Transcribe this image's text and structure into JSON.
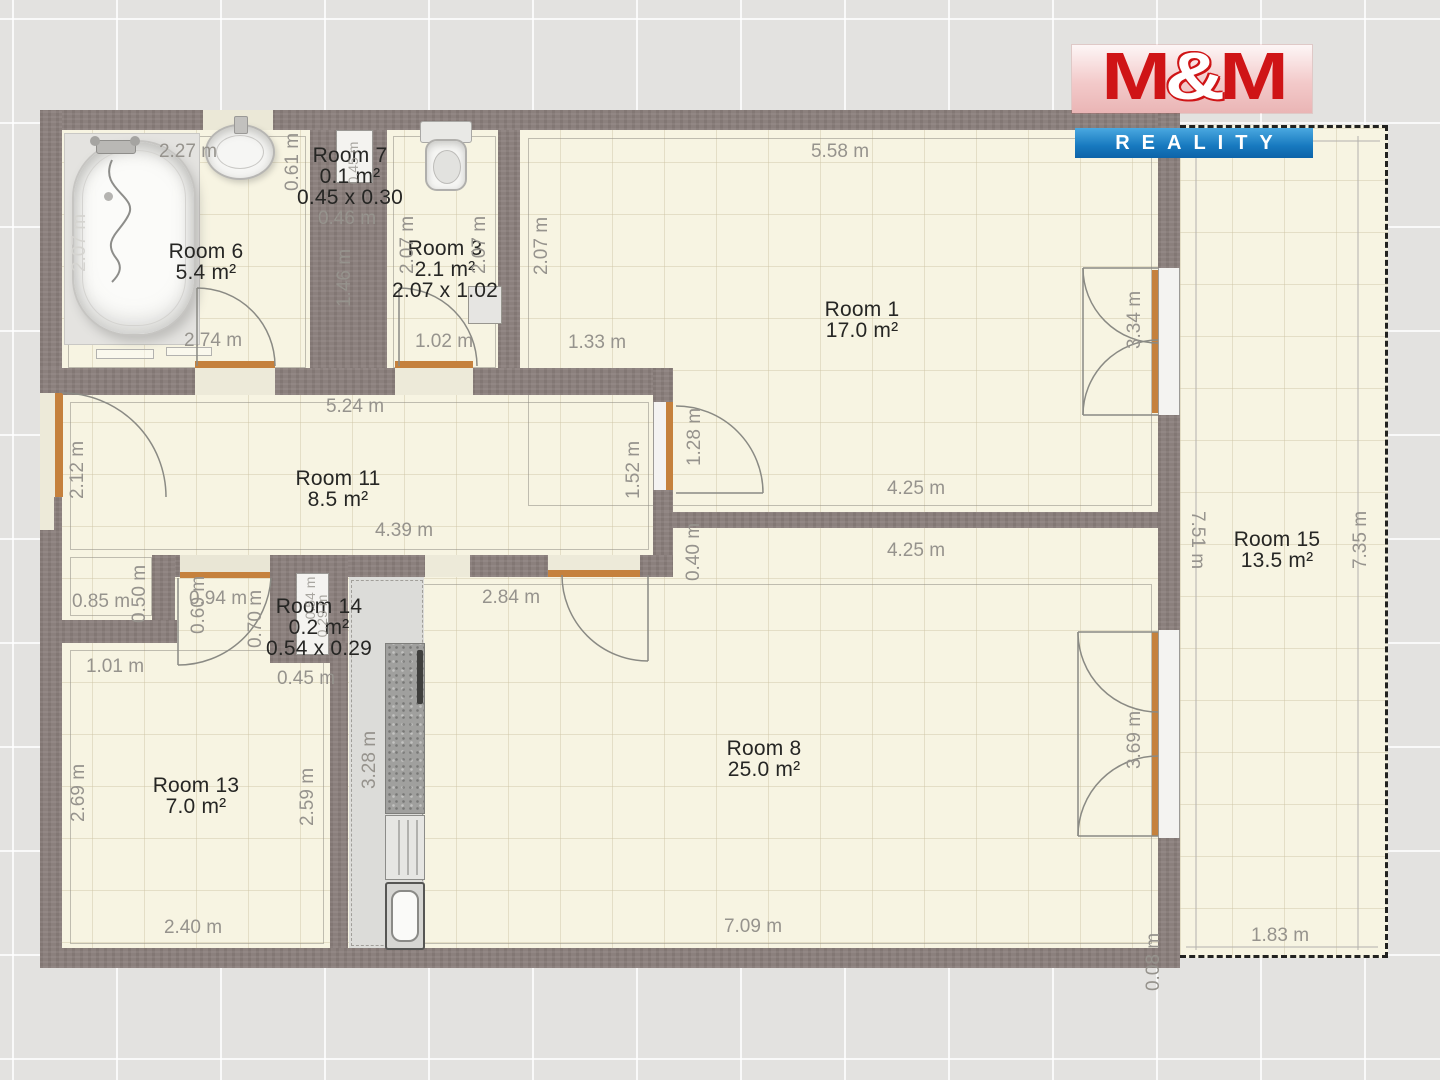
{
  "logo": {
    "m1": "M",
    "amp": "&",
    "m2": "M",
    "subtitle": "REALITY",
    "red": "#cf1416",
    "blue": "#1779bf"
  },
  "colors": {
    "wall": "#8b807d",
    "floor": "#f7f4e2",
    "threshold_orange": "#c5813d",
    "dimension_text": "#96938d",
    "room_text": "#262624",
    "outside_background": "#e3e2e0",
    "balcony_dash": "#222220"
  },
  "rooms": [
    {
      "id": "room-6",
      "x": 206,
      "y": 252,
      "lines": [
        "Room 6",
        "5.4 m²"
      ]
    },
    {
      "id": "room-7",
      "x": 350,
      "y": 156,
      "lines": [
        "Room 7",
        "0.1 m²",
        "0.45 x 0.30"
      ]
    },
    {
      "id": "room-3",
      "x": 445,
      "y": 249,
      "lines": [
        "Room 3",
        "2.1 m²",
        "2.07 x 1.02"
      ]
    },
    {
      "id": "room-1",
      "x": 862,
      "y": 310,
      "lines": [
        "Room 1",
        "17.0 m²"
      ]
    },
    {
      "id": "room-11",
      "x": 338,
      "y": 479,
      "lines": [
        "Room 11",
        "8.5 m²"
      ]
    },
    {
      "id": "room-14",
      "x": 319,
      "y": 607,
      "lines": [
        "Room 14",
        "0.2 m²",
        "0.54 x 0.29"
      ]
    },
    {
      "id": "room-13",
      "x": 196,
      "y": 786,
      "lines": [
        "Room 13",
        "7.0 m²"
      ]
    },
    {
      "id": "room-8",
      "x": 764,
      "y": 749,
      "lines": [
        "Room 8",
        "25.0 m²"
      ]
    },
    {
      "id": "room-15",
      "x": 1277,
      "y": 540,
      "lines": [
        "Room 15",
        "13.5 m²"
      ]
    }
  ],
  "dimensions": [
    {
      "text": "2.27 m",
      "x": 188,
      "y": 152
    },
    {
      "text": "0.61 m",
      "x": 293,
      "y": 162,
      "rot": -90
    },
    {
      "text": "0.46 m",
      "x": 347,
      "y": 219
    },
    {
      "text": "1.46 m",
      "x": 345,
      "y": 278,
      "rot": -90
    },
    {
      "text": "2.74 m",
      "x": 213,
      "y": 341
    },
    {
      "text": "2.07 m",
      "x": 80,
      "y": 243,
      "rot": -90,
      "cls": "light"
    },
    {
      "text": "5.58 m",
      "x": 840,
      "y": 152
    },
    {
      "text": "2.07 m",
      "x": 408,
      "y": 245,
      "rot": -90
    },
    {
      "text": "2.07 m",
      "x": 480,
      "y": 245,
      "rot": -90
    },
    {
      "text": "2.07 m",
      "x": 542,
      "y": 246,
      "rot": -90
    },
    {
      "text": "1.02 m",
      "x": 444,
      "y": 342
    },
    {
      "text": "1.33 m",
      "x": 597,
      "y": 343
    },
    {
      "text": "3.34 m",
      "x": 1135,
      "y": 320,
      "rot": -90
    },
    {
      "text": "5.24 m",
      "x": 355,
      "y": 407
    },
    {
      "text": "2.12 m",
      "x": 78,
      "y": 470,
      "rot": -90
    },
    {
      "text": "1.52 m",
      "x": 634,
      "y": 470,
      "rot": -90
    },
    {
      "text": "1.28 m",
      "x": 695,
      "y": 437,
      "rot": -90
    },
    {
      "text": "4.39 m",
      "x": 404,
      "y": 531
    },
    {
      "text": "4.25 m",
      "x": 916,
      "y": 489
    },
    {
      "text": "0.40 m",
      "x": 694,
      "y": 552,
      "rot": -90
    },
    {
      "text": "4.25 m",
      "x": 916,
      "y": 551
    },
    {
      "text": "0.85 m",
      "x": 101,
      "y": 602
    },
    {
      "text": "0.50 m",
      "x": 140,
      "y": 594,
      "rot": -90
    },
    {
      "text": "0.94 m",
      "x": 218,
      "y": 599
    },
    {
      "text": "0.60 m",
      "x": 199,
      "y": 605,
      "rot": -90
    },
    {
      "text": "0.70 m",
      "x": 256,
      "y": 619,
      "rot": -90
    },
    {
      "text": "2.84 m",
      "x": 511,
      "y": 598
    },
    {
      "text": "0.54 m",
      "x": 310,
      "y": 598,
      "rot": -90,
      "cls": "tiny"
    },
    {
      "text": "0.29 m",
      "x": 322,
      "y": 616,
      "rot": -90,
      "cls": "tiny"
    },
    {
      "text": "0.45 m",
      "x": 353,
      "y": 163,
      "rot": -90,
      "cls": "tiny"
    },
    {
      "text": "1.01 m",
      "x": 115,
      "y": 667
    },
    {
      "text": "0.45 m",
      "x": 306,
      "y": 679
    },
    {
      "text": "3.28 m",
      "x": 370,
      "y": 760,
      "rot": -90
    },
    {
      "text": "2.69 m",
      "x": 79,
      "y": 793,
      "rot": -90
    },
    {
      "text": "2.59 m",
      "x": 308,
      "y": 797,
      "rot": -90
    },
    {
      "text": "2.40 m",
      "x": 193,
      "y": 928
    },
    {
      "text": "7.09 m",
      "x": 753,
      "y": 927
    },
    {
      "text": "3.69 m",
      "x": 1135,
      "y": 740,
      "rot": -90
    },
    {
      "text": "7.51 m",
      "x": 1197,
      "y": 540,
      "rot": 90
    },
    {
      "text": "7.35 m",
      "x": 1361,
      "y": 540,
      "rot": -90
    },
    {
      "text": "1.83 m",
      "x": 1280,
      "y": 936
    },
    {
      "text": "0.08 m",
      "x": 1154,
      "y": 962,
      "rot": -90
    }
  ]
}
